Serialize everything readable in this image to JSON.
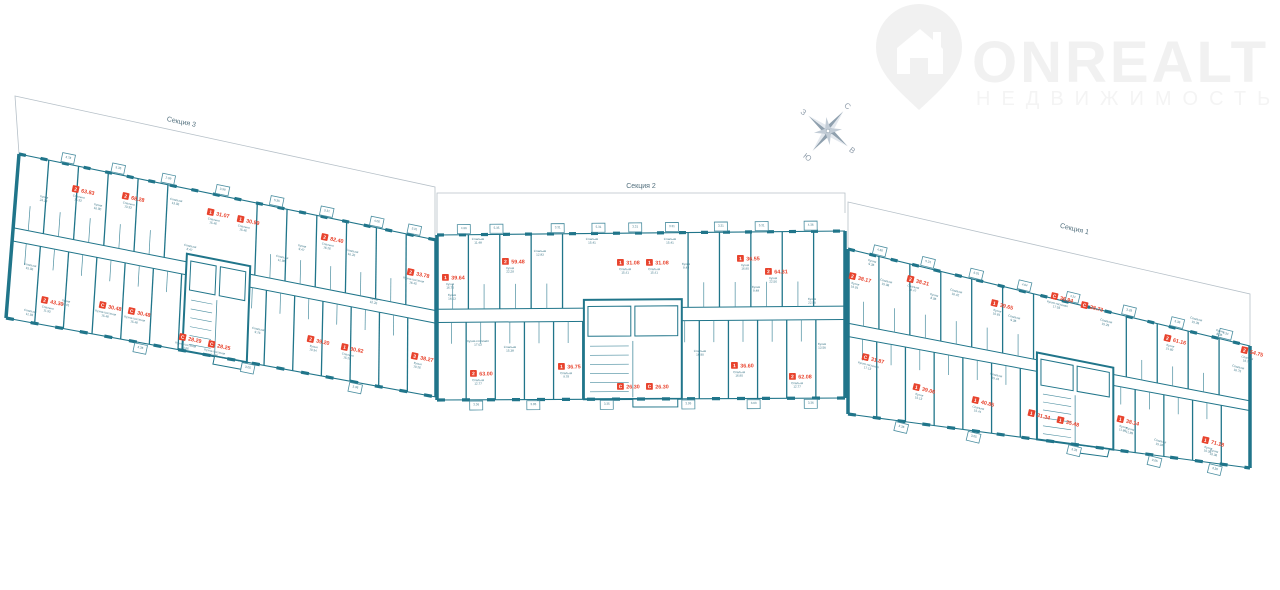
{
  "logo": {
    "brand": "ONREALT",
    "sub": "НЕДВИЖИМОСТЬ"
  },
  "compass": {
    "n": "С",
    "e": "В",
    "s": "Ю",
    "w": "З"
  },
  "palette": {
    "wall": "#20758a",
    "thin": "#4b8ea0",
    "red": "#e8432d",
    "roomText": "#417a8b",
    "outline": "#b6c0c8",
    "sectionText": "#53707e",
    "watermark": "#f1f1f1",
    "watermarkSub": "#f4f4f4",
    "compassDark": "#8fa0ae",
    "compassLight": "#e3e8ee",
    "compassMid": "#c2ccd6",
    "compassText": "#94a1ae"
  },
  "plan": {
    "sections": [
      {
        "name": "Секция 3",
        "label": {
          "x": 181,
          "y": 124,
          "angle": 11.5
        },
        "outline": [
          [
            19,
            154
          ],
          [
            15,
            96
          ],
          [
            435,
            187
          ],
          [
            435,
            240
          ]
        ],
        "quad": {
          "tl": [
            19,
            154
          ],
          "tr": [
            436,
            240
          ],
          "br": [
            436,
            397
          ],
          "bl": [
            6,
            318
          ]
        },
        "angle": 11.7,
        "walls": {
          "up": 13,
          "down": 14
        },
        "corridor": [
          0.45,
          0.53
        ],
        "core": [
          0.41,
          0.56
        ],
        "apartments": [
          {
            "t": "2",
            "area": "63.83",
            "x": 73,
            "y": 185,
            "sub": "Спальня|15.33"
          },
          {
            "t": "2",
            "area": "68.28",
            "x": 123,
            "y": 192,
            "sub": "Спальня|13.33"
          },
          {
            "t": "1",
            "area": "31.07",
            "x": 208,
            "y": 208,
            "sub": "Спальня|15.46"
          },
          {
            "t": "1",
            "area": "30.99",
            "x": 238,
            "y": 215,
            "sub": "Спальня|15.46"
          },
          {
            "t": "2",
            "area": "82.40",
            "x": 322,
            "y": 233,
            "sub": "Спальня|16.26"
          },
          {
            "t": "2",
            "area": "33.78",
            "x": 408,
            "y": 268,
            "sub": "Кухня-гостиная|16.45"
          },
          {
            "t": "2",
            "area": "43.30",
            "x": 42,
            "y": 296,
            "sub": "Спальня|11.93"
          },
          {
            "t": "С",
            "area": "30.48",
            "x": 100,
            "y": 301,
            "sub": "Кухня-гостиная|15.48"
          },
          {
            "t": "С",
            "area": "30.48",
            "x": 129,
            "y": 307,
            "sub": "Кухня-гостиная|15.48"
          },
          {
            "t": "С",
            "area": "28.29",
            "x": 180,
            "y": 333,
            "sub": "Кухня-гостиная|14.66"
          },
          {
            "t": "С",
            "area": "28.25",
            "x": 209,
            "y": 340,
            "sub": "Кухня-гостиная|14.66"
          },
          {
            "t": "2",
            "area": "39.20",
            "x": 308,
            "y": 335,
            "sub": "Кухня|10.34"
          },
          {
            "t": "1",
            "area": "30.82",
            "x": 342,
            "y": 343,
            "sub": "Спальня|15.29"
          },
          {
            "t": "3",
            "area": "38.27",
            "x": 412,
            "y": 352,
            "sub": "Кухня|10.26"
          }
        ],
        "rooms": [
          {
            "n": "Кухня",
            "a": "24.39",
            "x": 44,
            "y": 198
          },
          {
            "n": "Кухня",
            "a": "16.90",
            "x": 98,
            "y": 206
          },
          {
            "n": "Спальня",
            "a": "13.06",
            "x": 176,
            "y": 201
          },
          {
            "n": "Спальня",
            "a": "15.06",
            "x": 30,
            "y": 266
          },
          {
            "n": "Кухня",
            "a": "16.41",
            "x": 66,
            "y": 302
          },
          {
            "n": "Спальня",
            "a": "8.47",
            "x": 190,
            "y": 247
          },
          {
            "n": "Спальня",
            "a": "11.98",
            "x": 282,
            "y": 258
          },
          {
            "n": "Кухня",
            "a": "9.47",
            "x": 302,
            "y": 247
          },
          {
            "n": "Спальня",
            "a": "16.26",
            "x": 352,
            "y": 252
          },
          {
            "n": "Кухня",
            "a": "10.26",
            "x": 374,
            "y": 300
          },
          {
            "n": "Спальня",
            "a": "9.76",
            "x": 258,
            "y": 330
          },
          {
            "n": "Спальня",
            "a": "11.93",
            "x": 30,
            "y": 312
          }
        ],
        "balconiesTop": [
          [
            0.1,
            "3.78"
          ],
          [
            0.22,
            "5.35"
          ],
          [
            0.34,
            "2.99"
          ],
          [
            0.47,
            "3.99"
          ],
          [
            0.6,
            "5.35"
          ],
          [
            0.72,
            "3.31"
          ],
          [
            0.84,
            "4.06"
          ],
          [
            0.93,
            "3.31"
          ]
        ],
        "balconiesBottom": [
          [
            0.3,
            "3.36"
          ],
          [
            0.55,
            "3.05"
          ],
          [
            0.8,
            "3.36"
          ]
        ]
      },
      {
        "name": "Секция 2",
        "label": {
          "x": 641,
          "y": 188,
          "angle": 0
        },
        "outline": [
          [
            437,
            233
          ],
          [
            437,
            193
          ],
          [
            845,
            193
          ],
          [
            845,
            213
          ]
        ],
        "quad": {
          "tl": [
            437,
            235
          ],
          "tr": [
            845,
            231
          ],
          "br": [
            845,
            398
          ],
          "bl": [
            437,
            400
          ]
        },
        "angle": -0.5,
        "walls": {
          "up": 12,
          "down": 13
        },
        "corridor": [
          0.45,
          0.53
        ],
        "core": [
          0.36,
          0.6
        ],
        "apartments": [
          {
            "t": "1",
            "area": "39.64",
            "x": 442,
            "y": 274,
            "sub": "Кухня|16.73"
          },
          {
            "t": "2",
            "area": "59.48",
            "x": 502,
            "y": 258,
            "sub": "Кухня|22.28"
          },
          {
            "t": "1",
            "area": "31.08",
            "x": 617,
            "y": 259,
            "sub": "Спальня|15.41"
          },
          {
            "t": "1",
            "area": "31.08",
            "x": 646,
            "y": 259,
            "sub": "Спальня|15.41"
          },
          {
            "t": "1",
            "area": "36.55",
            "x": 737,
            "y": 255,
            "sub": "Кухня|16.90"
          },
          {
            "t": "2",
            "area": "64.31",
            "x": 765,
            "y": 268,
            "sub": "Кухня|22.56"
          },
          {
            "t": "2",
            "area": "63.00",
            "x": 470,
            "y": 370,
            "sub": "Спальня|12.77"
          },
          {
            "t": "1",
            "area": "36.75",
            "x": 558,
            "y": 363,
            "sub": "Спальня|9.78"
          },
          {
            "t": "С",
            "area": "26.30",
            "x": 617,
            "y": 383,
            "sub": null
          },
          {
            "t": "С",
            "area": "26.30",
            "x": 646,
            "y": 383,
            "sub": null
          },
          {
            "t": "1",
            "area": "36.60",
            "x": 731,
            "y": 362,
            "sub": "Спальня|16.90"
          },
          {
            "t": "2",
            "area": "62.08",
            "x": 789,
            "y": 373,
            "sub": "Спальня|12.77"
          }
        ],
        "rooms": [
          {
            "n": "Спальня",
            "a": "11.48",
            "x": 478,
            "y": 240
          },
          {
            "n": "Спальня",
            "a": "12.83",
            "x": 540,
            "y": 252
          },
          {
            "n": "Кухня",
            "a": "16.13",
            "x": 452,
            "y": 296
          },
          {
            "n": "Спальня",
            "a": "15.41",
            "x": 592,
            "y": 240
          },
          {
            "n": "Спальня",
            "a": "15.41",
            "x": 670,
            "y": 240
          },
          {
            "n": "Кухня",
            "a": "9.48",
            "x": 686,
            "y": 265
          },
          {
            "n": "Кухня",
            "a": "9.48",
            "x": 756,
            "y": 288
          },
          {
            "n": "Кухня",
            "a": "22.56",
            "x": 812,
            "y": 300
          },
          {
            "n": "Спальня",
            "a": "15.38",
            "x": 510,
            "y": 348
          },
          {
            "n": "Кухня-гостиная",
            "a": "17.03",
            "x": 478,
            "y": 342
          },
          {
            "n": "Спальня",
            "a": "16.90",
            "x": 700,
            "y": 352
          },
          {
            "n": "Кухня",
            "a": "13.56",
            "x": 822,
            "y": 345
          }
        ],
        "balconiesTop": [
          [
            0.05,
            "4.96"
          ],
          [
            0.13,
            "5.35"
          ],
          [
            0.28,
            "3.31"
          ],
          [
            0.38,
            "5.31"
          ],
          [
            0.47,
            "3.31"
          ],
          [
            0.56,
            "3.31"
          ],
          [
            0.68,
            "3.31"
          ],
          [
            0.78,
            "5.31"
          ],
          [
            0.9,
            "4.36"
          ]
        ],
        "balconiesBottom": [
          [
            0.08,
            "3.36"
          ],
          [
            0.22,
            "3.05"
          ],
          [
            0.4,
            "3.35"
          ],
          [
            0.6,
            "3.05"
          ],
          [
            0.76,
            "3.03"
          ],
          [
            0.9,
            "3.36"
          ]
        ]
      },
      {
        "name": "Секция 1",
        "label": {
          "x": 1074,
          "y": 231,
          "angle": 13.5
        },
        "outline": [
          [
            848,
            248
          ],
          [
            848,
            202
          ],
          [
            1250,
            294
          ],
          [
            1250,
            346
          ]
        ],
        "quad": {
          "tl": [
            848,
            249
          ],
          "tr": [
            1250,
            346
          ],
          "br": [
            1250,
            468
          ],
          "bl": [
            848,
            414
          ]
        },
        "angle": 13.6,
        "walls": {
          "up": 12,
          "down": 13
        },
        "corridor": [
          0.45,
          0.53
        ],
        "core": [
          0.47,
          0.66
        ],
        "apartments": [
          {
            "t": "2",
            "area": "38.17",
            "x": 850,
            "y": 272,
            "sub": "Кухня|16.91"
          },
          {
            "t": "2",
            "area": "38.21",
            "x": 908,
            "y": 275,
            "sub": "Спальня|16.47"
          },
          {
            "t": "1",
            "area": "39.65",
            "x": 992,
            "y": 299,
            "sub": "Кухня|10.81"
          },
          {
            "t": "С",
            "area": "36.94",
            "x": 1052,
            "y": 292,
            "sub": "Кухня-гостиная|17.55"
          },
          {
            "t": "С",
            "area": "28.73",
            "x": 1082,
            "y": 301,
            "sub": null
          },
          {
            "t": "2",
            "area": "61.16",
            "x": 1165,
            "y": 334,
            "sub": "Кухня|21.60"
          },
          {
            "t": "2",
            "area": "54.75",
            "x": 1242,
            "y": 346,
            "sub": "Спальня|16.75"
          },
          {
            "t": "С",
            "area": "31.87",
            "x": 863,
            "y": 353,
            "sub": "Кухня-гостиная|17.13"
          },
          {
            "t": "1",
            "area": "39.06",
            "x": 914,
            "y": 383,
            "sub": "Кухня|15.13"
          },
          {
            "t": "1",
            "area": "40.85",
            "x": 973,
            "y": 396,
            "sub": "Спальня|15.44"
          },
          {
            "t": "1",
            "area": "31.34",
            "x": 1029,
            "y": 409,
            "sub": null
          },
          {
            "t": "1",
            "area": "35.48",
            "x": 1058,
            "y": 416,
            "sub": null
          },
          {
            "t": "1",
            "area": "38.14",
            "x": 1118,
            "y": 415,
            "sub": "Кухня|11.89"
          },
          {
            "t": "1",
            "area": "71.18",
            "x": 1203,
            "y": 436,
            "sub": "Кухня|10.36"
          }
        ],
        "rooms": [
          {
            "n": "Кухня",
            "a": "9.36",
            "x": 872,
            "y": 262
          },
          {
            "n": "Спальня",
            "a": "15.08",
            "x": 886,
            "y": 282
          },
          {
            "n": "Кухня",
            "a": "8.06",
            "x": 934,
            "y": 296
          },
          {
            "n": "Спальня",
            "a": "16.42",
            "x": 956,
            "y": 292
          },
          {
            "n": "Спальня",
            "a": "9.36",
            "x": 1014,
            "y": 318
          },
          {
            "n": "Спальня",
            "a": "15.29",
            "x": 1106,
            "y": 322
          },
          {
            "n": "Спальня",
            "a": "15.39",
            "x": 1196,
            "y": 320
          },
          {
            "n": "Кухня",
            "a": "8.36",
            "x": 1220,
            "y": 332
          },
          {
            "n": "Спальня",
            "a": "16.75",
            "x": 1238,
            "y": 368
          },
          {
            "n": "Спальня",
            "a": "15.44",
            "x": 996,
            "y": 376
          },
          {
            "n": "Кухня",
            "a": "11.89",
            "x": 1130,
            "y": 430
          },
          {
            "n": "Спальня",
            "a": "15.04",
            "x": 1160,
            "y": 442
          },
          {
            "n": "Кухня",
            "a": "10.36",
            "x": 1214,
            "y": 452
          }
        ],
        "balconiesTop": [
          [
            0.06,
            "4.36"
          ],
          [
            0.18,
            "5.31"
          ],
          [
            0.3,
            "6.01"
          ],
          [
            0.42,
            "4.04"
          ],
          [
            0.54,
            "4.21"
          ],
          [
            0.68,
            "3.29"
          ],
          [
            0.8,
            "5.36"
          ],
          [
            0.92,
            "4.34"
          ]
        ],
        "balconiesBottom": [
          [
            0.12,
            "3.36"
          ],
          [
            0.3,
            "3.05"
          ],
          [
            0.55,
            "3.35"
          ],
          [
            0.75,
            "3.05"
          ],
          [
            0.9,
            "3.36"
          ]
        ]
      }
    ]
  }
}
